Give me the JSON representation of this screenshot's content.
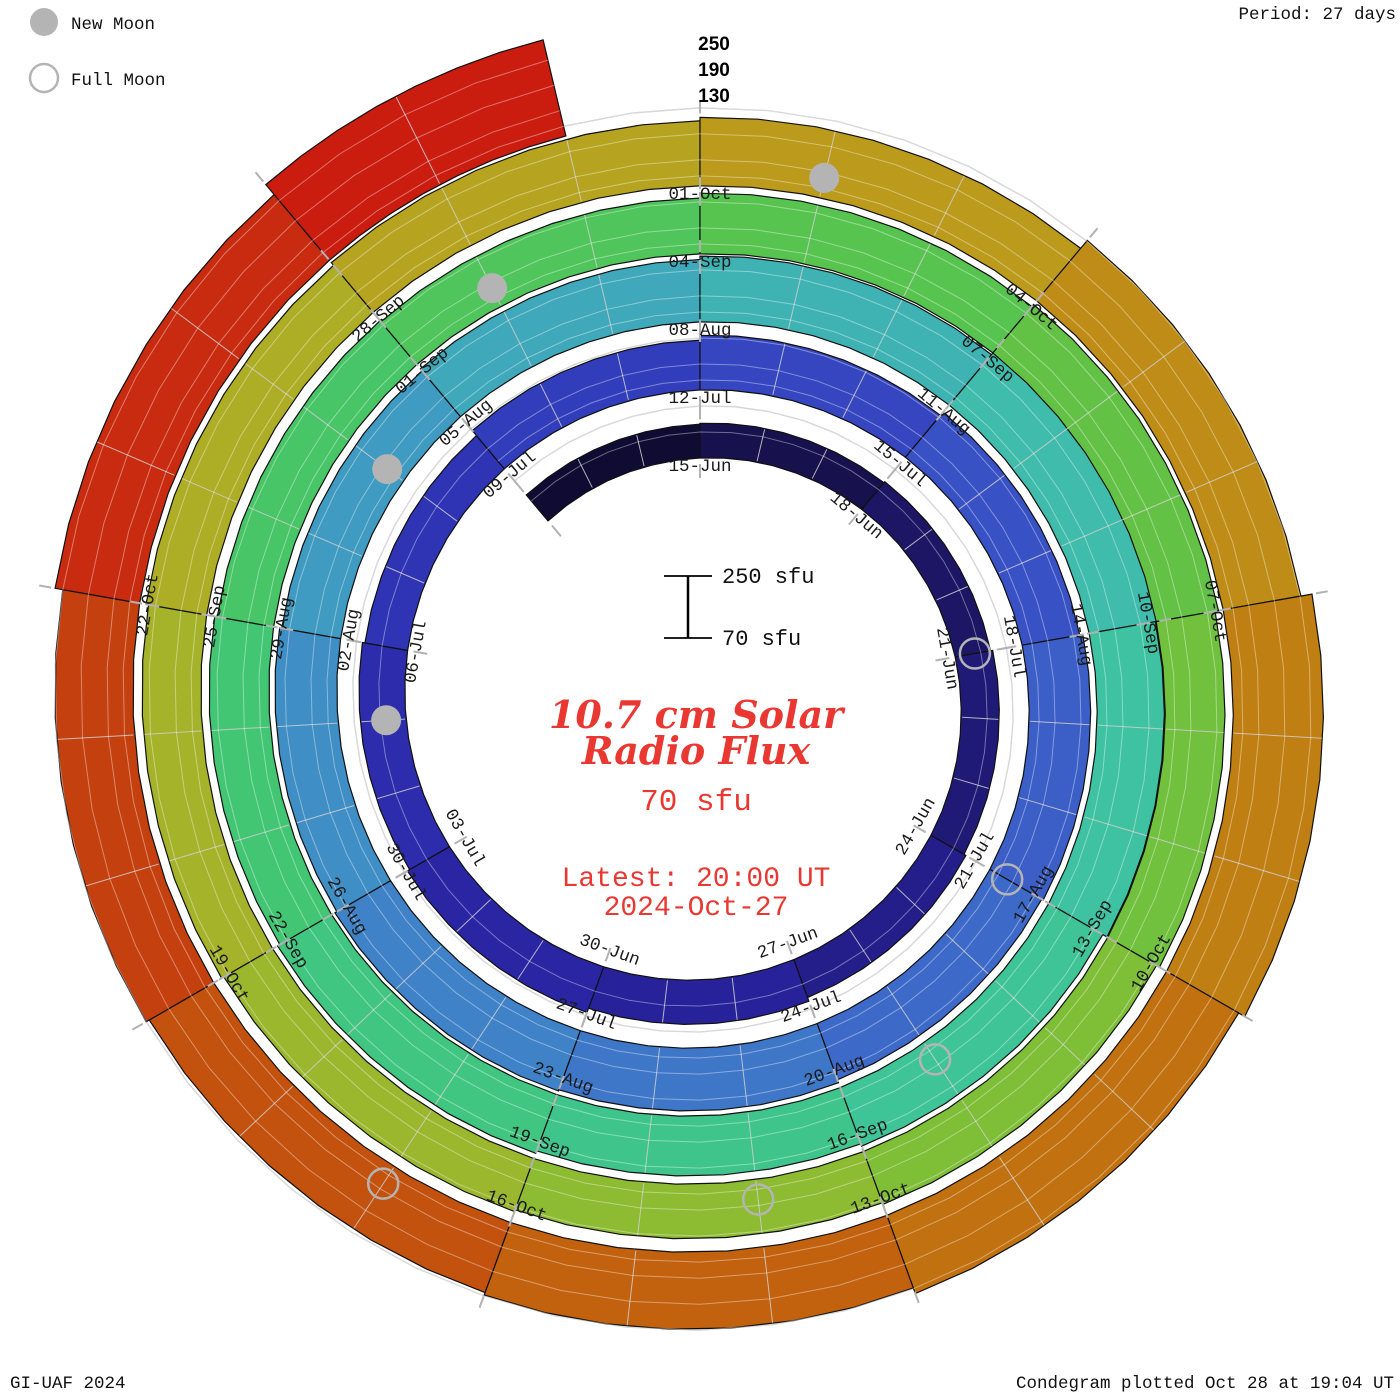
{
  "legend": {
    "new_moon": "New Moon",
    "full_moon": "Full Moon"
  },
  "header": {
    "period": "Period: 27 days"
  },
  "footer": {
    "credit": "GI-UAF 2024",
    "plotted": "Condegram plotted Oct 28 at 19:04 UT"
  },
  "center": {
    "title_line1": "10.7 cm Solar",
    "title_line2": "Radio Flux",
    "baseline_label": "70 sfu",
    "latest_line1": "Latest: 20:00 UT",
    "latest_line2": "2024-Oct-27",
    "accent_color": "#e93832"
  },
  "radial_scale": {
    "tick_labels": [
      "250",
      "190",
      "130"
    ],
    "sample_top": "250 sfu",
    "sample_bottom": "70 sfu"
  },
  "chart_data": {
    "type": "spiral-bar (condegram)",
    "title": "10.7 cm Solar Radio Flux",
    "units": "sfu",
    "period_days": 27,
    "baseline_sfu": 70,
    "max_scale_sfu": 250,
    "gridline_sfu": [
      130,
      190,
      250
    ],
    "start_date": "2024-06-12",
    "latest_date": "2024-10-27",
    "layout": "clockwise spiral, one turn = 27 days, 15-Jun at top of innermost turn, radius grows outward with time, bar height = flux above 70 sfu",
    "segments": [
      {
        "start": "12-Jun",
        "d": -3,
        "flux": 148
      },
      {
        "start": "15-Jun",
        "d": 0,
        "flux": 150
      },
      {
        "start": "18-Jun",
        "d": 3,
        "flux": 153
      },
      {
        "start": "21-Jun",
        "d": 6,
        "flux": 158
      },
      {
        "start": "24-Jun",
        "d": 9,
        "flux": 163
      },
      {
        "start": "27-Jun",
        "d": 12,
        "flux": 172
      },
      {
        "start": "30-Jun",
        "d": 15,
        "flux": 182
      },
      {
        "start": "03-Jul",
        "d": 18,
        "flux": 176
      },
      {
        "start": "06-Jul",
        "d": 21,
        "flux": 170
      },
      {
        "start": "09-Jul",
        "d": 24,
        "flux": 185
      },
      {
        "start": "12-Jul",
        "d": 27,
        "flux": 196
      },
      {
        "start": "15-Jul",
        "d": 30,
        "flux": 205
      },
      {
        "start": "18-Jul",
        "d": 33,
        "flux": 212
      },
      {
        "start": "21-Jul",
        "d": 36,
        "flux": 208
      },
      {
        "start": "24-Jul",
        "d": 39,
        "flux": 215
      },
      {
        "start": "27-Jul",
        "d": 42,
        "flux": 218
      },
      {
        "start": "30-Jul",
        "d": 45,
        "flux": 213
      },
      {
        "start": "02-Aug",
        "d": 48,
        "flux": 208
      },
      {
        "start": "05-Aug",
        "d": 51,
        "flux": 214
      },
      {
        "start": "08-Aug",
        "d": 54,
        "flux": 222
      },
      {
        "start": "11-Aug",
        "d": 57,
        "flux": 232
      },
      {
        "start": "14-Aug",
        "d": 60,
        "flux": 225
      },
      {
        "start": "17-Aug",
        "d": 63,
        "flux": 214
      },
      {
        "start": "20-Aug",
        "d": 66,
        "flux": 208
      },
      {
        "start": "23-Aug",
        "d": 69,
        "flux": 214
      },
      {
        "start": "26-Aug",
        "d": 72,
        "flux": 208
      },
      {
        "start": "29-Aug",
        "d": 75,
        "flux": 202
      },
      {
        "start": "01-Sep",
        "d": 78,
        "flux": 199
      },
      {
        "start": "04-Sep",
        "d": 81,
        "flux": 210
      },
      {
        "start": "07-Sep",
        "d": 84,
        "flux": 216
      },
      {
        "start": "10-Sep",
        "d": 87,
        "flux": 208
      },
      {
        "start": "13-Sep",
        "d": 90,
        "flux": 200
      },
      {
        "start": "16-Sep",
        "d": 93,
        "flux": 196
      },
      {
        "start": "19-Sep",
        "d": 96,
        "flux": 200
      },
      {
        "start": "22-Sep",
        "d": 99,
        "flux": 206
      },
      {
        "start": "25-Sep",
        "d": 102,
        "flux": 212
      },
      {
        "start": "28-Sep",
        "d": 105,
        "flux": 220
      },
      {
        "start": "01-Oct",
        "d": 108,
        "flux": 228
      },
      {
        "start": "04-Oct",
        "d": 111,
        "flux": 252
      },
      {
        "start": "07-Oct",
        "d": 114,
        "flux": 278
      },
      {
        "start": "10-Oct",
        "d": 117,
        "flux": 262
      },
      {
        "start": "13-Oct",
        "d": 120,
        "flux": 248
      },
      {
        "start": "16-Oct",
        "d": 123,
        "flux": 242
      },
      {
        "start": "19-Oct",
        "d": 126,
        "flux": 250
      },
      {
        "start": "22-Oct",
        "d": 129,
        "flux": 268
      },
      {
        "start": "25-Oct",
        "d": 132,
        "flux": 298
      }
    ],
    "date_labels": [
      {
        "text": "15-Jun",
        "d": 0
      },
      {
        "text": "18-Jun",
        "d": 3
      },
      {
        "text": "21-Jun",
        "d": 6
      },
      {
        "text": "24-Jun",
        "d": 9
      },
      {
        "text": "27-Jun",
        "d": 12
      },
      {
        "text": "30-Jun",
        "d": 15
      },
      {
        "text": "03-Jul",
        "d": 18
      },
      {
        "text": "06-Jul",
        "d": 21
      },
      {
        "text": "09-Jul",
        "d": 24
      },
      {
        "text": "12-Jul",
        "d": 27
      },
      {
        "text": "15-Jul",
        "d": 30
      },
      {
        "text": "18-Jul",
        "d": 33
      },
      {
        "text": "21-Jul",
        "d": 36
      },
      {
        "text": "24-Jul",
        "d": 39
      },
      {
        "text": "27-Jul",
        "d": 42
      },
      {
        "text": "30-Jul",
        "d": 45
      },
      {
        "text": "02-Aug",
        "d": 48
      },
      {
        "text": "05-Aug",
        "d": 51
      },
      {
        "text": "08-Aug",
        "d": 54
      },
      {
        "text": "11-Aug",
        "d": 57
      },
      {
        "text": "14-Aug",
        "d": 60
      },
      {
        "text": "17-Aug",
        "d": 63
      },
      {
        "text": "20-Aug",
        "d": 66
      },
      {
        "text": "23-Aug",
        "d": 69
      },
      {
        "text": "26-Aug",
        "d": 72
      },
      {
        "text": "29-Aug",
        "d": 75
      },
      {
        "text": "01-Sep",
        "d": 78
      },
      {
        "text": "04-Sep",
        "d": 81
      },
      {
        "text": "07-Sep",
        "d": 84
      },
      {
        "text": "10-Sep",
        "d": 87
      },
      {
        "text": "13-Sep",
        "d": 90
      },
      {
        "text": "16-Sep",
        "d": 93
      },
      {
        "text": "19-Sep",
        "d": 96
      },
      {
        "text": "22-Sep",
        "d": 99
      },
      {
        "text": "25-Sep",
        "d": 102
      },
      {
        "text": "28-Sep",
        "d": 105
      },
      {
        "text": "01-Oct",
        "d": 108
      },
      {
        "text": "04-Oct",
        "d": 111
      },
      {
        "text": "07-Oct",
        "d": 114
      },
      {
        "text": "10-Oct",
        "d": 117
      },
      {
        "text": "13-Oct",
        "d": 120
      },
      {
        "text": "16-Oct",
        "d": 123
      },
      {
        "text": "19-Oct",
        "d": 126
      },
      {
        "text": "22-Oct",
        "d": 129
      }
    ],
    "moons": {
      "new": [
        {
          "date": "05-Jul",
          "d": 20
        },
        {
          "date": "04-Aug",
          "d": 50
        },
        {
          "date": "02-Sep",
          "d": 79
        },
        {
          "date": "02-Oct",
          "d": 109
        }
      ],
      "full": [
        {
          "date": "21-Jun",
          "d": 6
        },
        {
          "date": "21-Jul",
          "d": 36
        },
        {
          "date": "19-Aug",
          "d": 65
        },
        {
          "date": "17-Sep",
          "d": 94
        },
        {
          "date": "17-Oct",
          "d": 124
        }
      ]
    },
    "color_stops": [
      [
        -3,
        "#0c0824"
      ],
      [
        3,
        "#1a145a"
      ],
      [
        12,
        "#262094"
      ],
      [
        18,
        "#2b28a8"
      ],
      [
        24,
        "#3038b8"
      ],
      [
        30,
        "#364ac2"
      ],
      [
        36,
        "#3c64c8"
      ],
      [
        42,
        "#3f7cc8"
      ],
      [
        48,
        "#3f94c4"
      ],
      [
        54,
        "#3faeb8"
      ],
      [
        60,
        "#3fc1a6"
      ],
      [
        66,
        "#3ec592"
      ],
      [
        72,
        "#40c67a"
      ],
      [
        78,
        "#4ac560"
      ],
      [
        84,
        "#5cc34a"
      ],
      [
        90,
        "#78bf3a"
      ],
      [
        96,
        "#94b92e"
      ],
      [
        102,
        "#aab128"
      ],
      [
        108,
        "#baa01e"
      ],
      [
        114,
        "#c08614"
      ],
      [
        120,
        "#c16a0f"
      ],
      [
        126,
        "#c44a0f"
      ],
      [
        131,
        "#c82810"
      ],
      [
        135,
        "#cd1410"
      ]
    ],
    "marker_color": "#b4b4b4",
    "gridline_color": "#c4c4c4"
  }
}
